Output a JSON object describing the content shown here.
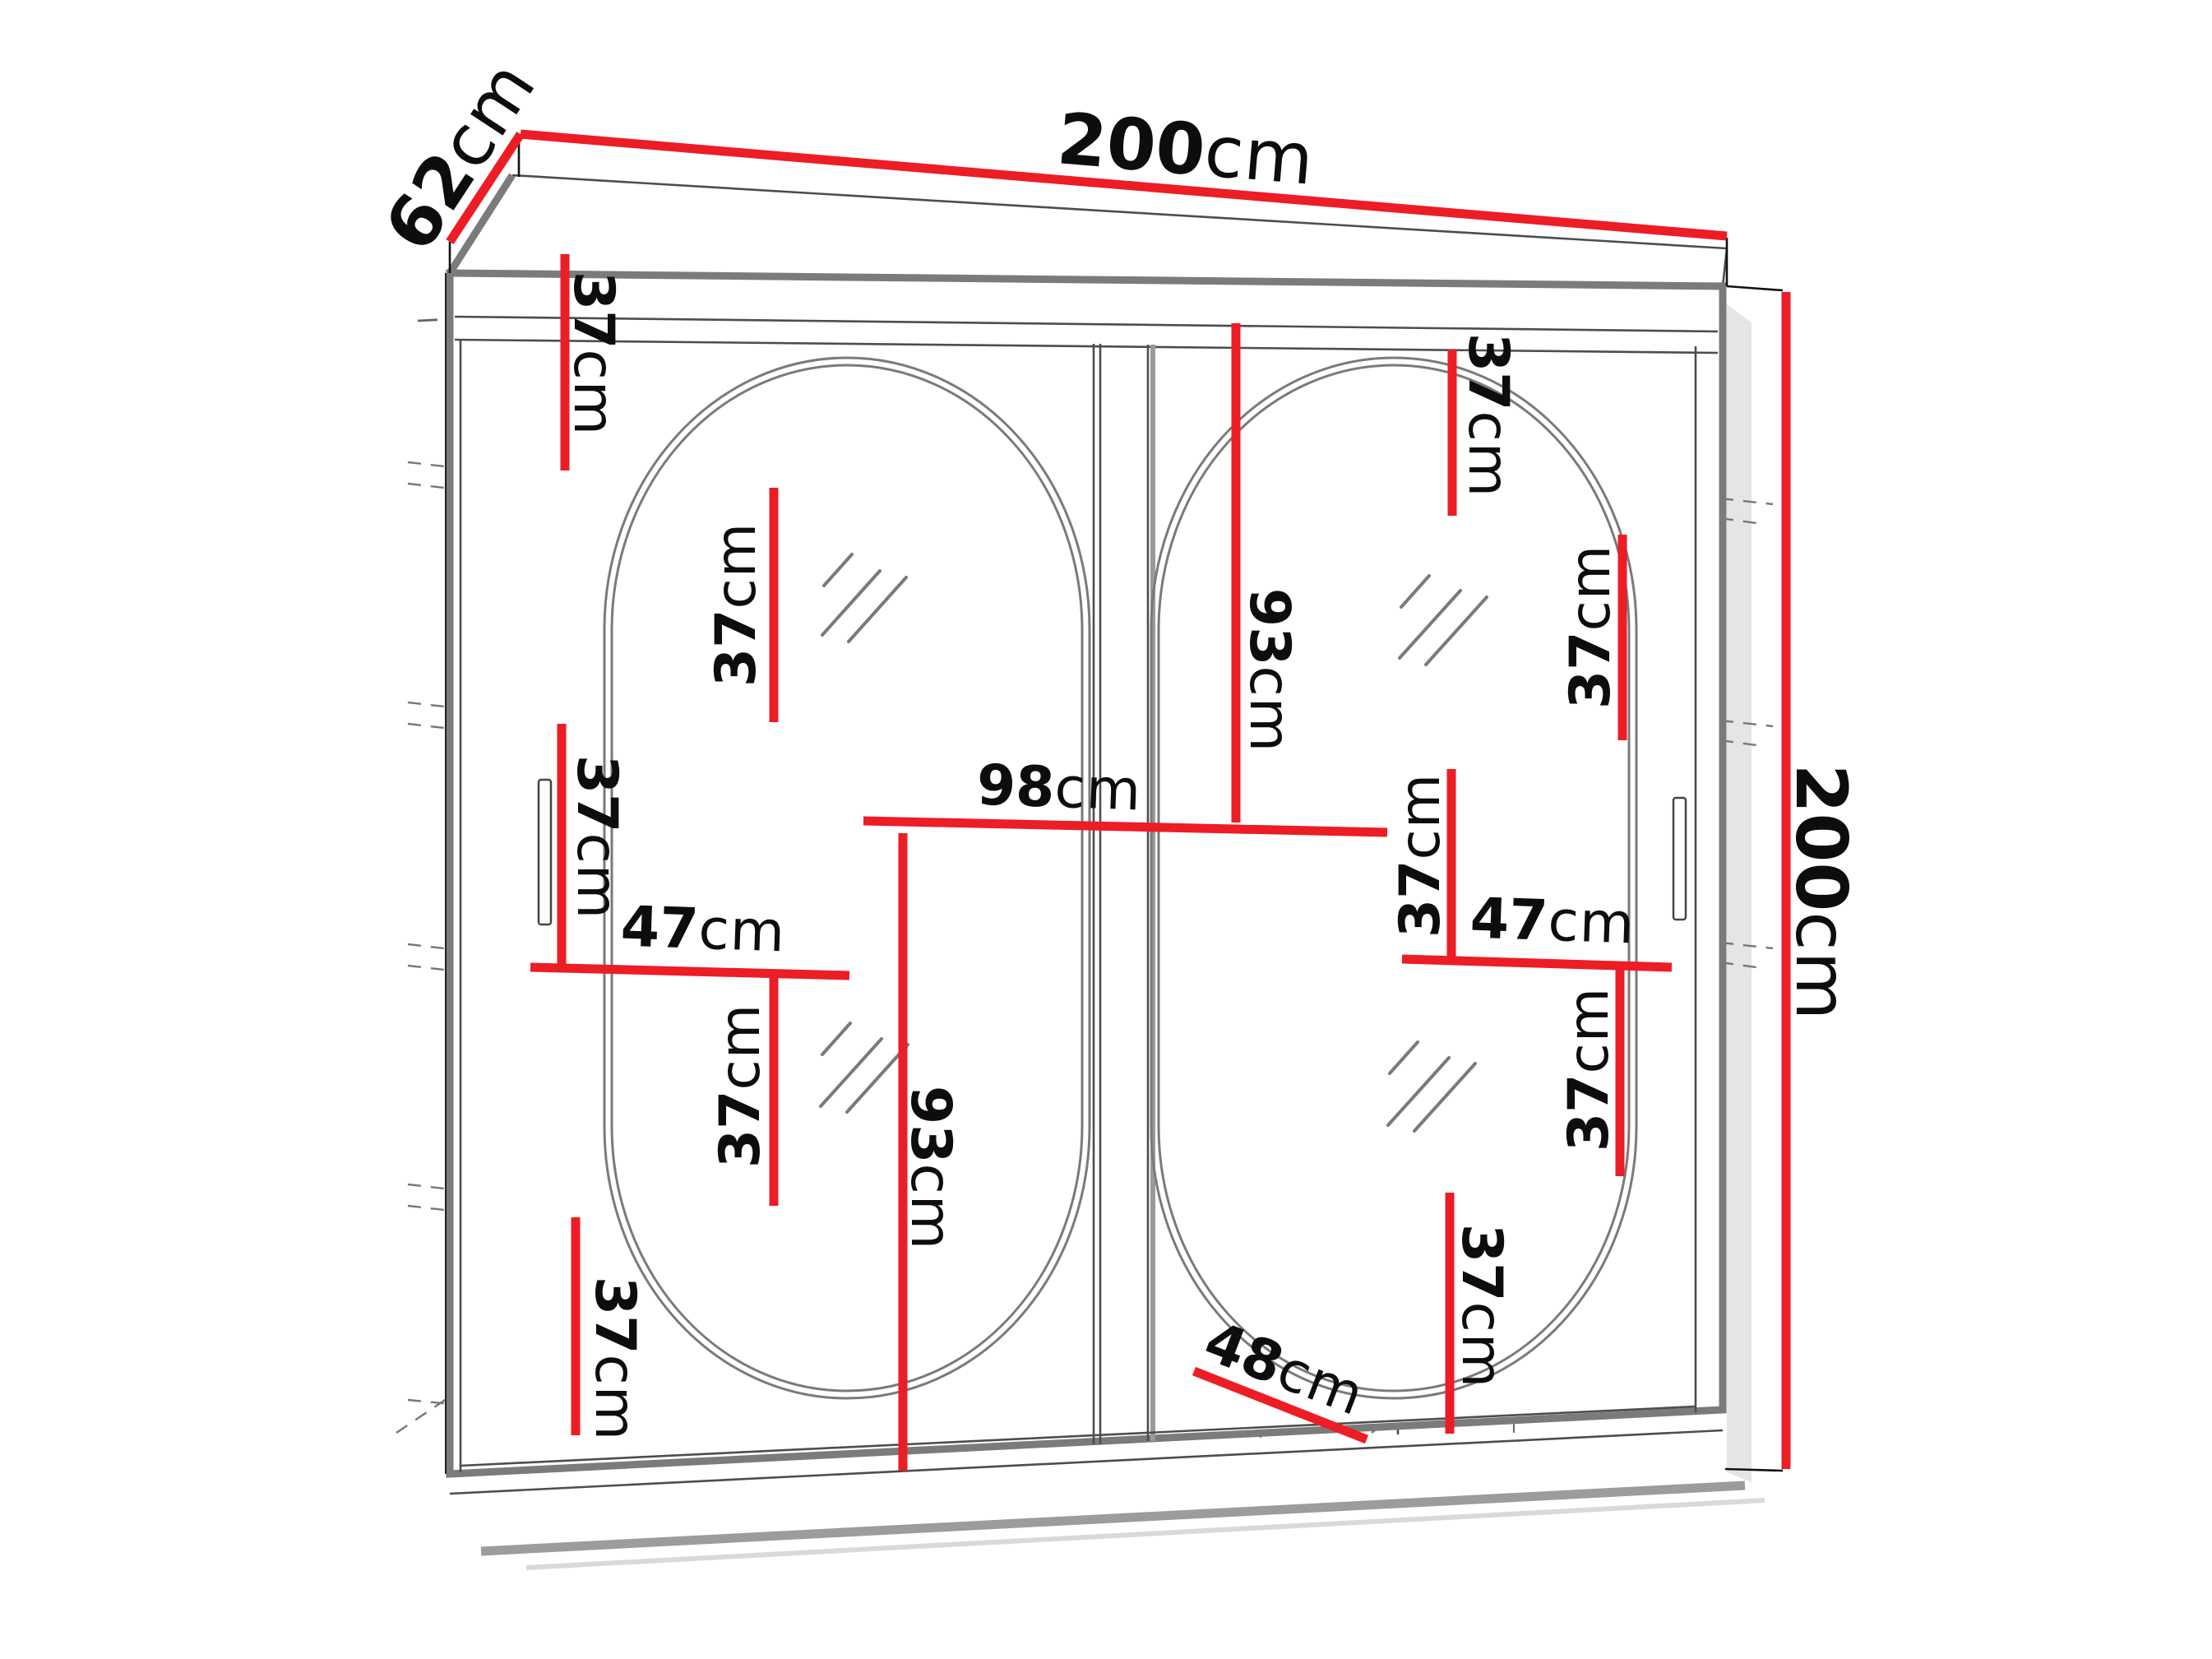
{
  "diagram": {
    "kind": "wardrobe dimension diagram",
    "accent_color": "#ec1d24",
    "unit": "cm"
  },
  "labels": [
    {
      "id": "depth",
      "num": "62",
      "unit": "cm"
    },
    {
      "id": "width",
      "num": "200",
      "unit": "cm"
    },
    {
      "id": "height",
      "num": "200",
      "unit": "cm"
    },
    {
      "id": "left-gap-1",
      "num": "37",
      "unit": "cm"
    },
    {
      "id": "left-gap-2",
      "num": "37",
      "unit": "cm"
    },
    {
      "id": "left-gap-3",
      "num": "37",
      "unit": "cm"
    },
    {
      "id": "left-shelf-width",
      "num": "47",
      "unit": "cm"
    },
    {
      "id": "left-gap-4",
      "num": "37",
      "unit": "cm"
    },
    {
      "id": "left-gap-5",
      "num": "37",
      "unit": "cm"
    },
    {
      "id": "left-hanging-height",
      "num": "93",
      "unit": "cm"
    },
    {
      "id": "center-shelf-width",
      "num": "98",
      "unit": "cm"
    },
    {
      "id": "right-hanging-height",
      "num": "93",
      "unit": "cm"
    },
    {
      "id": "right-gap-1",
      "num": "37",
      "unit": "cm"
    },
    {
      "id": "right-gap-2",
      "num": "37",
      "unit": "cm"
    },
    {
      "id": "right-gap-3",
      "num": "37",
      "unit": "cm"
    },
    {
      "id": "right-shelf-width",
      "num": "47",
      "unit": "cm"
    },
    {
      "id": "right-gap-4",
      "num": "37",
      "unit": "cm"
    },
    {
      "id": "right-gap-5",
      "num": "37",
      "unit": "cm"
    },
    {
      "id": "interior-depth",
      "num": "48",
      "unit": "cm"
    }
  ]
}
